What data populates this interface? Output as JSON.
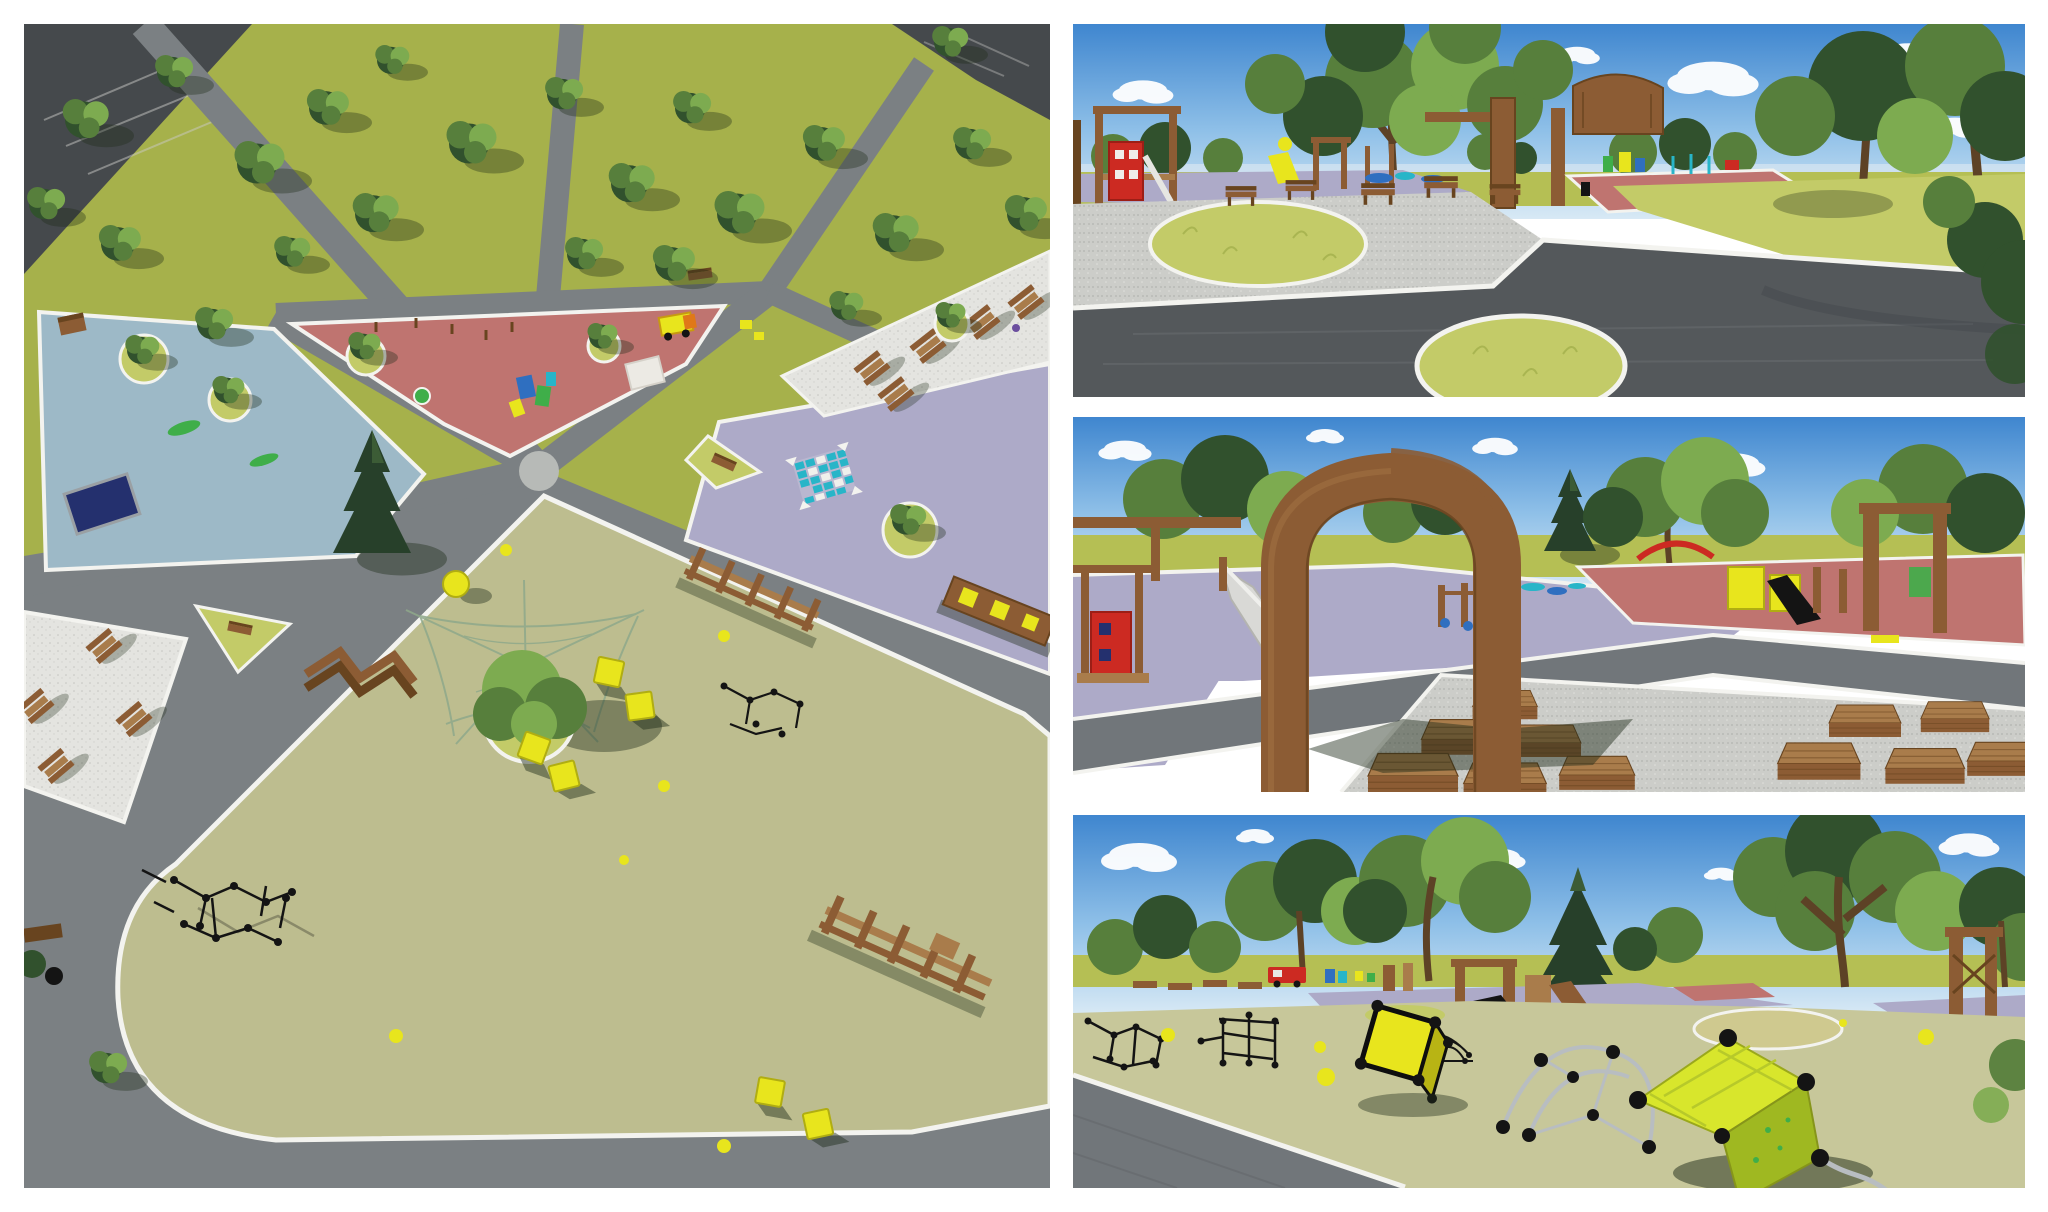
{
  "page": {
    "background": "#ffffff",
    "kind": "photo-collage",
    "panel_count": 4
  },
  "collage": {
    "panels": [
      {
        "id": "aerial-masterplan",
        "alt": "Aerial 3D render of a park master plan: lawns with trees, radiating grey paths, a pink playground triangle, a blue playground court, a purple plaza with a blue game grid, white paved areas with wooden picnic tables, and a large olive play field with black rope climbers, yellow cubes and wooden obstacle courses"
      },
      {
        "id": "plaza-perspective",
        "alt": "Eye-level render of a paved park plaza with dark paver paths, white curbs, grass mounds, wooden benches, a wooden entrance gate and colourful playgrounds under a blue sky"
      },
      {
        "id": "wooden-gate-perspective",
        "alt": "Render looking through a large wooden arch gate onto a purple play surface with a slide, outdoor fitness gear, a rose playground and clusters of brown picnic tables on gravel"
      },
      {
        "id": "rope-climbers-perspective",
        "alt": "Render of a sage-green play field with black rope climbing frames, tilted yellow cube climbers with black ball joints, wooden towers with slides and trees on the horizon"
      }
    ]
  },
  "palette": {
    "bg": "#ffffff",
    "sky_top": "#3f86cf",
    "sky_mid": "#8fc0e8",
    "sky_low": "#d8e9f5",
    "cloud": "#ffffff",
    "field": "#b5bf54",
    "lawn": "#a6b14b",
    "grass_light": "#c3cb68",
    "tree_dark": "#31512d",
    "tree_mid": "#577f3c",
    "tree_light": "#7dab50",
    "conifer": "#27402a",
    "trunk": "#5d4226",
    "shadow": "#1d2a18",
    "path": "#7b8083",
    "road_dark": "#45494c",
    "road_light": "#989c9e",
    "paver_dark": "#54585b",
    "paver_mid": "#71767a",
    "curb": "#f3f3ef",
    "paving": "#e4e4e0",
    "gravel": "#cccdc9",
    "pink": "#bf7470",
    "lavender": "#adaac8",
    "blue_surface": "#9db9c7",
    "olive": "#bdbd8f",
    "sage": "#c7c79a",
    "wood": "#8c5c34",
    "wood_dark": "#68441f",
    "wood_light": "#a97c4b",
    "yellow": "#e8e51d",
    "yellow_green": "#d8e62c",
    "black": "#141414",
    "steel": "#b8bdc1",
    "blue": "#2f6fc0",
    "teal": "#28b5c8",
    "red": "#cc2a22",
    "green": "#3fae49",
    "navy": "#24306e",
    "white_item": "#eceae4"
  }
}
